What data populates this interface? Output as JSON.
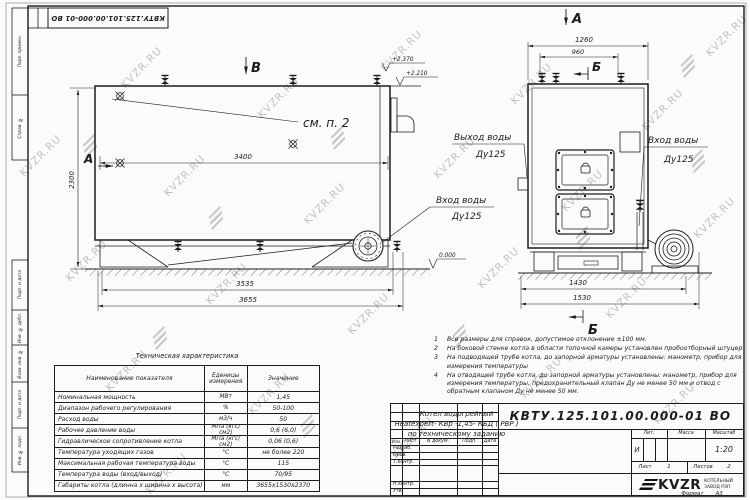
{
  "stamp": {
    "code": "КВТУ.125.101.00.000-01 ВО"
  },
  "watermark": {
    "text": "KVZR.RU"
  },
  "margin_labels": [
    "Перв. примен.",
    "Справ. №",
    "Подп. и дата",
    "Инв. № дубл.",
    "Взам. инв. №",
    "Подп. и дата",
    "Инв. № подл."
  ],
  "side_view": {
    "section_b": "В",
    "section_a": "А",
    "elev_top": "+2.370",
    "elev_top2": "+2.210",
    "see_note": "см. п. 2",
    "dim_inner": "3400",
    "dim_height": "2300",
    "inlet_line1": "Вход воды",
    "inlet_line2": "Ду125",
    "elev_zero": "0.000",
    "dim_len1": "3535",
    "dim_len2": "3655"
  },
  "front_view": {
    "section_a": "А",
    "section_b_top": "Б",
    "section_b_bottom": "Б",
    "dim_top1": "1260",
    "dim_top2": "960",
    "outlet_line1": "Выход воды",
    "outlet_line2": "Ду125",
    "inlet_line1": "Вход воды",
    "inlet_line2": "Ду125",
    "dim_bot1": "1430",
    "dim_bot2": "1530"
  },
  "notes": [
    {
      "num": "1",
      "text": "Все размеры для справок, допустимое отклонение ±100 мм."
    },
    {
      "num": "2",
      "text": "На боковой стенке котла в области топочной камеры установлен пробоотборный штуцер"
    },
    {
      "num": "3",
      "text": "На подводящей трубе котла, до запорной арматуры установлены: манометр, прибор для измерения температуры"
    },
    {
      "num": "4",
      "text": "На отводящей трубе котла, до запорной арматуры установлены: манометр, прибор для измерения температуры, предохранительный клапан Ду не менее 50 мм и отвод с обратным клапаном Ду не менее 50 мм."
    }
  ],
  "tech_table": {
    "title": "Техническая характеристика",
    "col1": "Наименование показателя",
    "col2": "Еденицы измерения",
    "col3": "Значение",
    "rows": [
      {
        "name": "Номинальная мощность",
        "unit": "МВт",
        "value": "1,45"
      },
      {
        "name": "Диапазон рабочего регулирования",
        "unit": "%",
        "value": "50-100"
      },
      {
        "name": "Расход воды",
        "unit": "м3/ч",
        "value": "50"
      },
      {
        "name": "Рабочее давление воды",
        "unit": "МПа (кгс/см2)",
        "value": "0,6 (6,0)"
      },
      {
        "name": "Гидравлическое сопротивление котла",
        "unit": "МПа (кгс/см2)",
        "value": "0,06 (0,6)"
      },
      {
        "name": "Температура уходящих газов",
        "unit": "°С",
        "value": "не более 220"
      },
      {
        "name": "Максимальная рабочая температура воды",
        "unit": "°С",
        "value": "115"
      },
      {
        "name": "Температура воды (вход/выход)",
        "unit": "°С",
        "value": "70/95"
      },
      {
        "name": "Габариты котла (длинна х ширина х высота)",
        "unit": "мм",
        "value": "3655х1530х2370"
      }
    ]
  },
  "title_block": {
    "designation": "КВТУ.125.101.00.000-01 ВО",
    "name1": "Котел водогрейный",
    "name2": "Heatexpert- КВр -1,45- КБД ( РВР )",
    "name3": "по техническому заданию",
    "col_izm": "Изм.",
    "col_list": "Лист",
    "col_doc": "N докум.",
    "col_podp": "Подп.",
    "col_data": "Дата",
    "row_razrab": "Разраб.",
    "row_prov": "Пров.",
    "row_tkontr": "Т.контр.",
    "row_nkontr": "Н.контр.",
    "row_utv": "Утв.",
    "lit_label": "Лит.",
    "mass_label": "Масса",
    "scale_label": "Масштаб",
    "lit_value": "И",
    "scale_value": "1:20",
    "sheet_label": "Лист",
    "sheet_value": "1",
    "sheets_label": "Листов",
    "sheets_value": "2",
    "logo": "KVZR",
    "company1": "КОТЕЛЬНЫЙ",
    "company2": "ЗАВОД РЭП",
    "format_label": "Формат",
    "format_value": "А3"
  }
}
